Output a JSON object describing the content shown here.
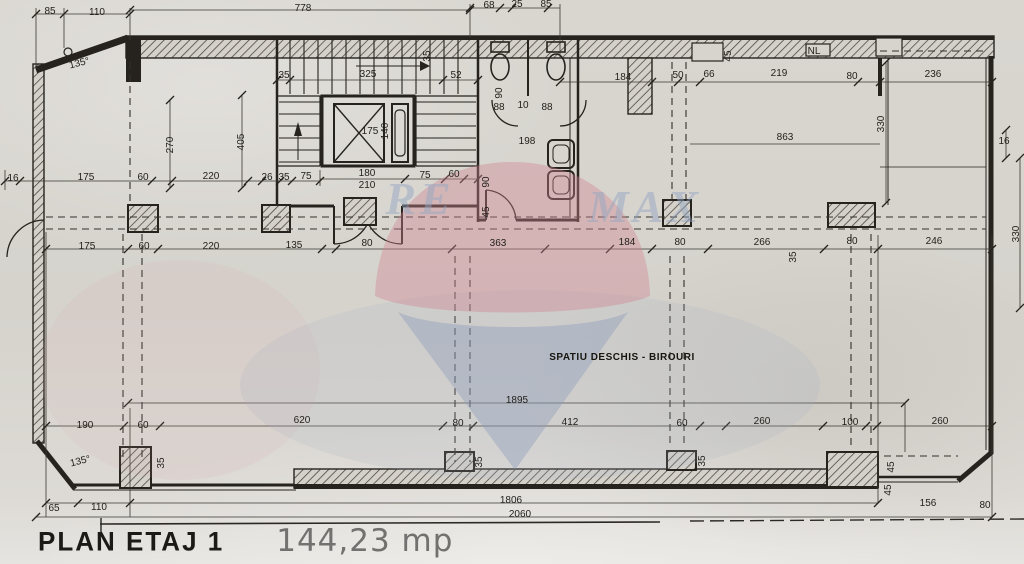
{
  "plan": {
    "title": "PLAN ETAJ 1",
    "area": "144,23 mp",
    "room_label": "SPATIU DESCHIS - BIROURI",
    "watermark": {
      "left": "RE",
      "right": "MAX",
      "balloon_top_color": "#cf8590",
      "balloon_bottom_color": "#8c9cb8",
      "letter_color": "#93a6c2"
    },
    "ink_color": "#26231e",
    "labels": [
      {
        "t": "85",
        "x": 50,
        "y": 14
      },
      {
        "t": "110",
        "x": 97,
        "y": 15
      },
      {
        "t": "778",
        "x": 303,
        "y": 11
      },
      {
        "t": "68",
        "x": 489,
        "y": 8
      },
      {
        "t": "25",
        "x": 517,
        "y": 7
      },
      {
        "t": "85",
        "x": 546,
        "y": 7
      },
      {
        "t": "135°",
        "x": 80,
        "y": 66,
        "r": -14
      },
      {
        "t": "35",
        "x": 284,
        "y": 78
      },
      {
        "t": "325",
        "x": 368,
        "y": 77
      },
      {
        "t": "52",
        "x": 456,
        "y": 78
      },
      {
        "t": "35",
        "x": 430,
        "y": 56,
        "r": -90,
        "fs": 9
      },
      {
        "t": "184",
        "x": 623,
        "y": 80
      },
      {
        "t": "50",
        "x": 678,
        "y": 78
      },
      {
        "t": "66",
        "x": 709,
        "y": 77
      },
      {
        "t": "219",
        "x": 779,
        "y": 76
      },
      {
        "t": "80",
        "x": 852,
        "y": 79
      },
      {
        "t": "236",
        "x": 933,
        "y": 77
      },
      {
        "t": "NL",
        "x": 814,
        "y": 54,
        "fs": 11
      },
      {
        "t": "45",
        "x": 731,
        "y": 56,
        "r": -90,
        "fs": 9
      },
      {
        "t": "270",
        "x": 173,
        "y": 145,
        "r": -90
      },
      {
        "t": "405",
        "x": 244,
        "y": 142,
        "r": -90
      },
      {
        "t": "175",
        "x": 370,
        "y": 134
      },
      {
        "t": "140",
        "x": 388,
        "y": 131,
        "r": -90,
        "fs": 9
      },
      {
        "t": "90",
        "x": 502,
        "y": 93,
        "r": -90,
        "fs": 9
      },
      {
        "t": "88",
        "x": 499,
        "y": 110,
        "fs": 9
      },
      {
        "t": "10",
        "x": 523,
        "y": 108,
        "fs": 9
      },
      {
        "t": "88",
        "x": 547,
        "y": 110,
        "fs": 9
      },
      {
        "t": "198",
        "x": 527,
        "y": 144
      },
      {
        "t": "863",
        "x": 785,
        "y": 140
      },
      {
        "t": "330",
        "x": 884,
        "y": 124,
        "r": -90
      },
      {
        "t": "16",
        "x": 1004,
        "y": 144
      },
      {
        "t": "330",
        "x": 1019,
        "y": 234,
        "r": -90
      },
      {
        "t": "16",
        "x": 13,
        "y": 181
      },
      {
        "t": "175",
        "x": 86,
        "y": 180
      },
      {
        "t": "60",
        "x": 143,
        "y": 180
      },
      {
        "t": "220",
        "x": 211,
        "y": 179
      },
      {
        "t": "26",
        "x": 267,
        "y": 180,
        "fs": 9
      },
      {
        "t": "35",
        "x": 284,
        "y": 180,
        "fs": 9
      },
      {
        "t": "75",
        "x": 306,
        "y": 179
      },
      {
        "t": "180",
        "x": 367,
        "y": 176
      },
      {
        "t": "210",
        "x": 367,
        "y": 188
      },
      {
        "t": "75",
        "x": 425,
        "y": 178
      },
      {
        "t": "60",
        "x": 454,
        "y": 177
      },
      {
        "t": "90",
        "x": 489,
        "y": 182,
        "r": -90,
        "fs": 9
      },
      {
        "t": "45",
        "x": 489,
        "y": 212,
        "r": -90,
        "fs": 9
      },
      {
        "t": "175",
        "x": 87,
        "y": 249
      },
      {
        "t": "60",
        "x": 144,
        "y": 249
      },
      {
        "t": "220",
        "x": 211,
        "y": 249
      },
      {
        "t": "135",
        "x": 294,
        "y": 248
      },
      {
        "t": "80",
        "x": 367,
        "y": 246
      },
      {
        "t": "363",
        "x": 498,
        "y": 246
      },
      {
        "t": "184",
        "x": 627,
        "y": 245
      },
      {
        "t": "80",
        "x": 680,
        "y": 245
      },
      {
        "t": "266",
        "x": 762,
        "y": 245
      },
      {
        "t": "80",
        "x": 852,
        "y": 244
      },
      {
        "t": "246",
        "x": 934,
        "y": 244
      },
      {
        "t": "35",
        "x": 796,
        "y": 257,
        "r": -90,
        "fs": 9
      },
      {
        "t": "SPATIU DESCHIS - BIROURI",
        "x": 622,
        "y": 360,
        "fs": 11,
        "b": 1
      },
      {
        "t": "1895",
        "x": 517,
        "y": 403
      },
      {
        "t": "190",
        "x": 85,
        "y": 428
      },
      {
        "t": "60",
        "x": 143,
        "y": 428
      },
      {
        "t": "620",
        "x": 302,
        "y": 423
      },
      {
        "t": "80",
        "x": 458,
        "y": 426
      },
      {
        "t": "412",
        "x": 570,
        "y": 425
      },
      {
        "t": "60",
        "x": 682,
        "y": 426
      },
      {
        "t": "260",
        "x": 762,
        "y": 424
      },
      {
        "t": "100",
        "x": 850,
        "y": 425
      },
      {
        "t": "260",
        "x": 940,
        "y": 424
      },
      {
        "t": "135°",
        "x": 81,
        "y": 464,
        "r": -14
      },
      {
        "t": "35",
        "x": 164,
        "y": 463,
        "r": -90,
        "fs": 9
      },
      {
        "t": "35",
        "x": 482,
        "y": 462,
        "r": -90,
        "fs": 9
      },
      {
        "t": "35",
        "x": 705,
        "y": 461,
        "r": -90,
        "fs": 9
      },
      {
        "t": "45",
        "x": 894,
        "y": 467,
        "r": -90,
        "fs": 9
      },
      {
        "t": "45",
        "x": 891,
        "y": 490,
        "r": -90,
        "fs": 9
      },
      {
        "t": "65",
        "x": 54,
        "y": 511
      },
      {
        "t": "110",
        "x": 99,
        "y": 510
      },
      {
        "t": "1806",
        "x": 511,
        "y": 503
      },
      {
        "t": "156",
        "x": 928,
        "y": 506
      },
      {
        "t": "80",
        "x": 985,
        "y": 508
      },
      {
        "t": "2060",
        "x": 520,
        "y": 517
      }
    ]
  }
}
